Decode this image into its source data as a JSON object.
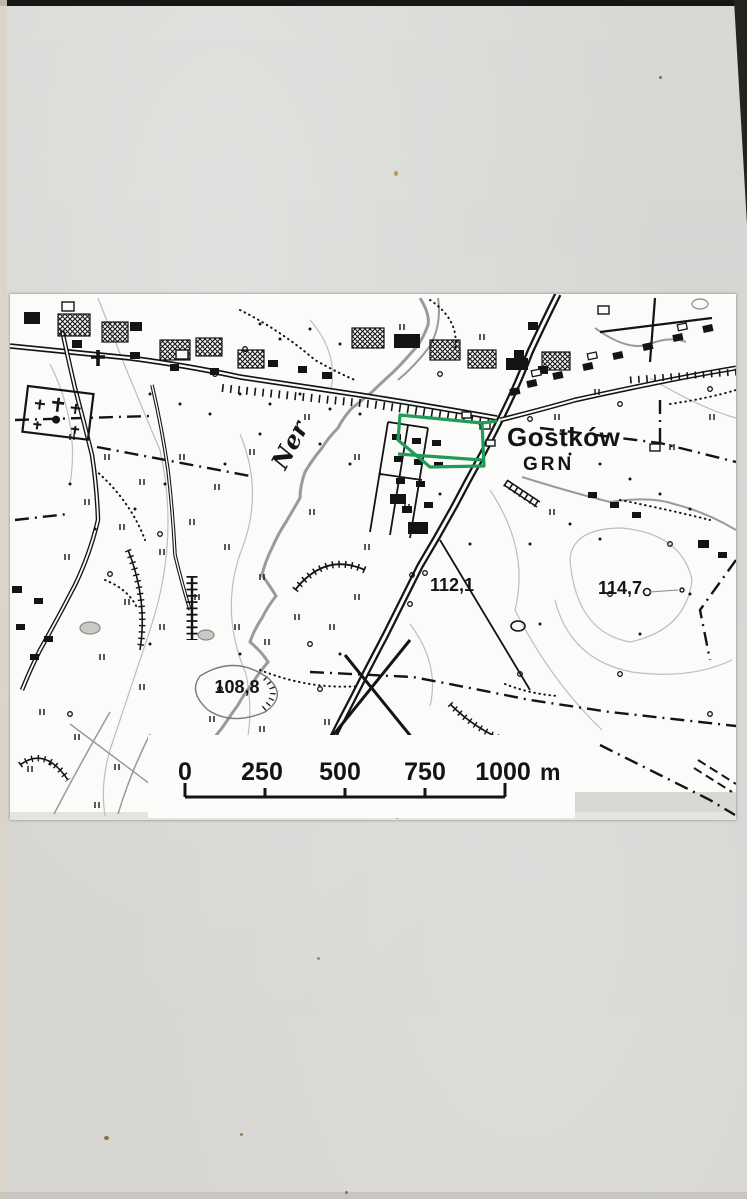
{
  "map": {
    "town_label": "Gostków",
    "municipality_label": "GRN",
    "river_label": "Ner",
    "elevations": {
      "e112": "112,1",
      "e114": "114,7",
      "e108": "108,8"
    },
    "scale_bar": {
      "labels": [
        "0",
        "250",
        "500",
        "750",
        "1000"
      ],
      "unit": "m"
    },
    "colors": {
      "highlight_green": "#1f9c58",
      "map_ink": "#141414",
      "river_gray": "#9a9a9a",
      "contour_gray": "#bdbdbd",
      "photo_white": "#fbfbf9",
      "paper_gray": "#d6d6d3"
    }
  }
}
